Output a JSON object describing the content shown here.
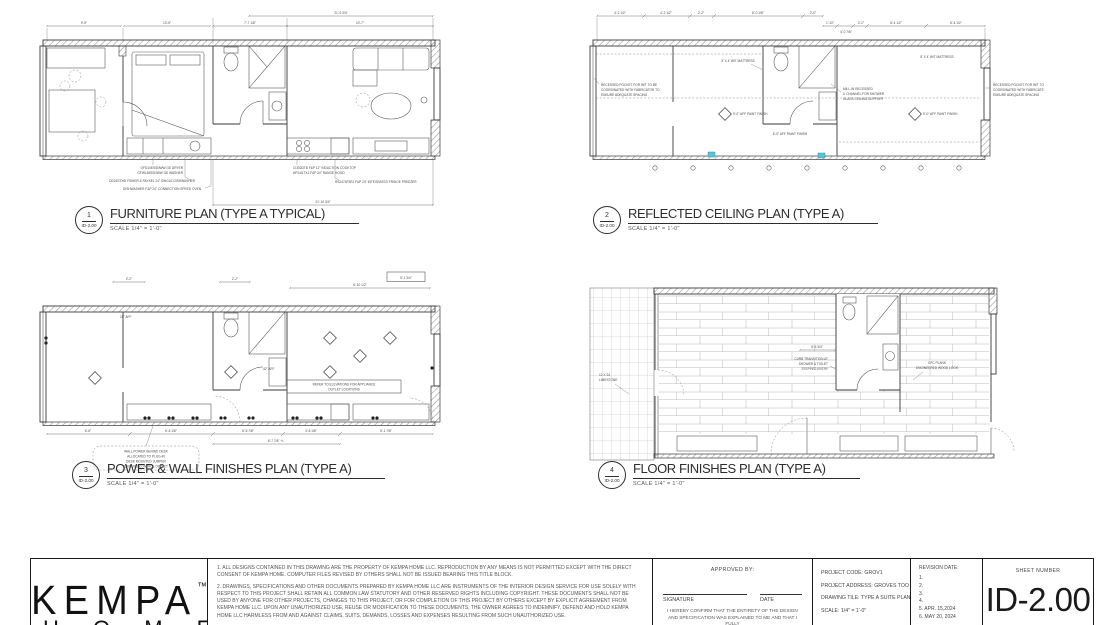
{
  "colors": {
    "line": "#3a3a3a",
    "hatch": "#9b9b9b",
    "accent_cyan": "#58c5d5"
  },
  "plans": [
    {
      "num": "1",
      "ref": "ID-2.00",
      "title": "FURNITURE PLAN (TYPE A TYPICAL)",
      "scale": "SCALE  1/4\" = 1'-0\"",
      "dims": {
        "overall": "21'-9 3/4\"",
        "seg1": "9'-5\"",
        "seg2": "13'-5\"",
        "bath": "7'-7 1/8\"",
        "living": "10'-7\"",
        "bottom": "21'-10 3/4\""
      },
      "callouts": {
        "c1a": "GFD14ESSNWW GE DRYER",
        "c1b": "GFW148SSNWW GE WASHER",
        "c2": "DD24STX6I FISHER & PAYKEL 24\" SINGLE DISHWASHER",
        "c3": "DISHWASHER F&P 24\" CONNECTION SPEED OVEN",
        "c4": "CI302DTB F&P 12\" INDUCTION COOKTOP",
        "c5": "HP24ILTX1 F&P 24\" RANGE HOOD",
        "c6": "RS2474F3RJ F&P 24\" INTEGRATED FRIDGE FREEZER"
      }
    },
    {
      "num": "2",
      "ref": "ID-2.00",
      "title": "REFLECTED CEILING PLAN (TYPE A)",
      "scale": "SCALE  1/4\" = 1'-0\"",
      "top_dims": [
        "4'-2 1/2\"",
        "4'-2 1/2\"",
        "2'-2\"",
        "8'-0 1/8\"",
        "2'-0\"",
        "1'-10\"",
        "4'-0 7/8\"",
        "2'-2\"",
        "8'-4 1/2\"",
        "8'-4 1/2\""
      ],
      "notes": {
        "l1": "RECESSED POCKET FOR W/T TO BE",
        "l2": "COORDINATED WITH FABRICATOR TO",
        "l3": "ENSURE ADEQUATE SPACING",
        "r1": "RECESSED POCKET FOR W/T TO",
        "r2": "COORDINATED WITH FABRICATE",
        "r3": "ENSURE ADEQUATE SPACING",
        "ch1": "MILL-IN RECESSED",
        "ch2": "U CHANNEL FOR SHOWER",
        "ch3": "GLASS CEILING SUPPORT",
        "bath_aff": "5'-0\" AFF PAINT FINISH",
        "left_wt": "5' X 4' W/T MATTRESS",
        "right_wt": "8' X 4' W/T MATTRESS",
        "left_aff": "9'-0\" AFF PAINT FINISH",
        "right_aff": "9'-0\" AFF PAINT FINISH"
      }
    },
    {
      "num": "3",
      "ref": "ID-2.00",
      "title": "POWER & WALL FINISHES PLAN (TYPE A)",
      "scale": "SCALE  1/4\" = 1'-0\"",
      "top_dims": [
        "2'-2\"",
        "2'-2\"",
        "6'-10 1/2\"",
        "5'-1 3/4\""
      ],
      "bottom_dims": [
        "6'-6\"",
        "6'-6 1/8\"",
        "6'-5 7/8\"",
        "3'-8 1/8\"",
        "5'-1 7/8\"",
        "6'-7 7/8\" +/-"
      ],
      "aff": [
        "18\" AFF",
        "42\" AFF"
      ],
      "note_box": {
        "b1": "REFER TO ELEVATIONS FOR APPLIANCE",
        "b2": "OUTLET LOCATIONS"
      },
      "bubble": {
        "n1": "WALL POWER BEHIND DESK",
        "n2": "ALLOCATED TO PLUG-IN",
        "n3": "DESK MOUNTED JUMPER",
        "n4": "GROUND CONTROL OUTLET"
      }
    },
    {
      "num": "4",
      "ref": "ID-2.00",
      "title": "FLOOR FINISHES PLAN (TYPE A)",
      "scale": "SCALE  1/4\" = 1'-0\"",
      "callouts": {
        "t1": "12 X 24",
        "t2": "LIMESTONE",
        "tr1": "CURB TRANSITION AT",
        "tr2": "SHOWER & TOILET",
        "tr3": "STEPPED ENTRY",
        "dim": "5'-6 3/4\"",
        "p1": "SPC PLANK",
        "p2": "ENGINEERED WOOD LOOK"
      }
    }
  ],
  "sheet": {
    "logo": {
      "brand": "KEMPA",
      "tm": "™",
      "sub": "H O M E"
    },
    "notes": {
      "p1": "1. ALL DESIGNS CONTAINED IN THIS DRAWING ARE THE PROPERTY OF KEMPA HOME LLC. REPRODUCTION BY ANY MEANS IS NOT PERMITTED EXCEPT WITH THE DIRECT CONSENT OF KEMPA HOME. COMPUTER FILES REVISED BY OTHERS SHALL NOT BE ISSUED BEARING THIS TITLE BLOCK.",
      "p2": "2. DRAWINGS, SPECIFICATIONS AND OTHER DOCUMENTS PREPARED BY KEMPA HOME LLC ARE INSTRUMENTS OF THE INTERIOR DESIGN SERVICE FOR USE SOLELY WITH RESPECT TO THIS PROJECT SHALL RETAIN ALL COMMON LAW STATUTORY AND OTHER RESERVED RIGHTS INCLUDING COPYRIGHT. THESE DOCUMENTS SHALL NOT BE USED BY ANYONE FOR OTHER PROJECTS, CHANGES TO THIS PROJECT, OR FOR COMPLETION OF THIS PROJECT BY OTHERS EXCEPT BY EXPLICIT AGREEMENT FROM KEMPA HOME LLC. UPON ANY UNAUTHORIZED USE, REUSE OR MODIFICATION TO THESE DOCUMENTS, THE OWNER AGREES TO INDEMNIFY, DEFEND AND HOLD KEMPA HOME LLC HARMLESS FROM AND AGAINST CLAIMS, SUITS, DEMANDS, LOSSES AND EXPENSES RESULTING FROM SUCH UNAUTHORIZED USE."
    },
    "approval": {
      "label": "APPROVED BY:",
      "signature_label": "SIGNATURE",
      "date_label": "DATE",
      "confirm": "I HEREBY CONFIRM THAT THE ENTIRETY OF THE DESIGN AND SPECIFICATION WAS EXPLAINED TO ME AND THAT I FULLY"
    },
    "project": {
      "code": "PROJECT CODE: GROV1",
      "address": "PROJECT ADDRESS: GROVES TOO",
      "drawing_title": "DRAWING TILE: TYPE A SUITE PLANS",
      "scale": "SCALE: 1/4\" = 1'-0\""
    },
    "revision": {
      "label": "REVISION DATE:",
      "items": [
        "1.",
        "2.",
        "3.",
        "4.",
        "5. APR. 15,2024",
        "6. MAY 20, 2024"
      ]
    },
    "sheet_number_label": "SHEET NUMBER",
    "sheet_number": "ID-2.00"
  }
}
